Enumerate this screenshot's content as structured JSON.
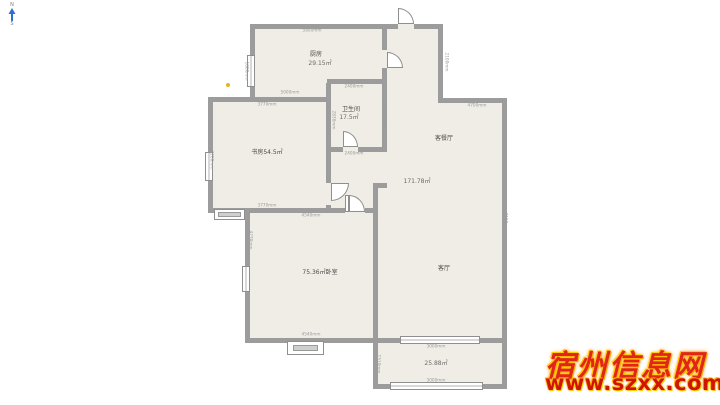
{
  "compass": {
    "north": "N",
    "south": "S"
  },
  "plan": {
    "rooms": {
      "kitchen": {
        "name": "厨房",
        "area": "29.15㎡"
      },
      "study": {
        "label": "书房54.5㎡"
      },
      "bathroom": {
        "name": "卫生间",
        "area": "17.5㎡"
      },
      "dining": {
        "name": "客餐厅"
      },
      "living": {
        "name": "客厅",
        "area": "171.78㎡"
      },
      "bedroom": {
        "label": "75.36㎡卧室"
      },
      "balcony": {
        "area": "25.88㎡"
      }
    },
    "dimensions": [
      "5800mm",
      "2100mm",
      "4700mm",
      "5000mm",
      "3770mm",
      "2400mm",
      "2830mm",
      "2830mm",
      "2400mm",
      "3770mm",
      "4540mm",
      "4540mm",
      "4230mm",
      "7150mm",
      "3000mm",
      "3000mm",
      "1510mm",
      "1510mm",
      "3200mm",
      "1800mm"
    ]
  },
  "watermark": {
    "site_name": "宿州信息网",
    "site_url": "www.szxx.com.cn"
  },
  "colors": {
    "wall": "#9c9c9c",
    "floor": "#efede5",
    "watermark_red": "#e1251b",
    "watermark_glow": "#ffb400",
    "compass_arrow": "#2e6fd0",
    "marker_dot": "#e6b41e"
  }
}
